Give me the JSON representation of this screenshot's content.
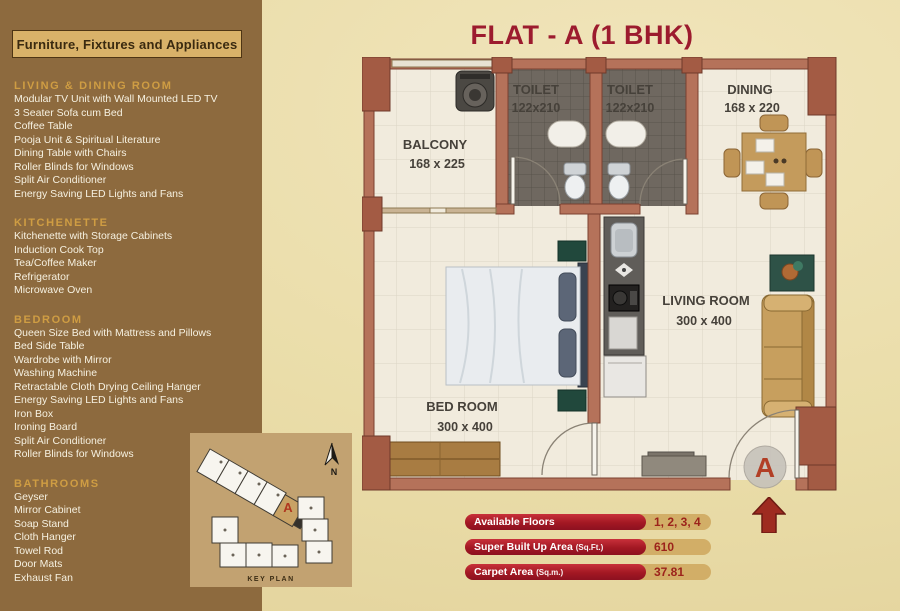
{
  "title": "FLAT - A (1 BHK)",
  "sidebar": {
    "header": "Furniture, Fixtures and Appliances",
    "sections": [
      {
        "title": "LIVING & DINING ROOM",
        "items": [
          "Modular TV Unit with Wall Mounted LED TV",
          "3 Seater Sofa cum Bed",
          "Coffee Table",
          "Pooja Unit & Spiritual Literature",
          "Dining Table with Chairs",
          "Roller Blinds for Windows",
          "Split Air Conditioner",
          "Energy Saving LED Lights and Fans"
        ]
      },
      {
        "title": "KITCHENETTE",
        "items": [
          "Kitchenette with Storage Cabinets",
          "Induction Cook Top",
          "Tea/Coffee Maker",
          "Refrigerator",
          "Microwave Oven"
        ]
      },
      {
        "title": "BEDROOM",
        "items": [
          "Queen Size Bed with Mattress and Pillows",
          "Bed Side Table",
          "Wardrobe with Mirror",
          "Washing Machine",
          "Retractable Cloth Drying Ceiling Hanger",
          "Energy Saving LED Lights and Fans",
          "Iron Box",
          "Ironing Board",
          "Split Air Conditioner",
          "Roller Blinds for Windows"
        ]
      },
      {
        "title": "BATHROOMS",
        "items": [
          "Geyser",
          "Mirror Cabinet",
          "Soap Stand",
          "Cloth Hanger",
          "Towel Rod",
          "Door Mats",
          "Exhaust Fan"
        ]
      }
    ]
  },
  "key_plan": {
    "label": "KEY PLAN",
    "north": "N",
    "unit": "A"
  },
  "floor_plan": {
    "unit_marker": "A",
    "rooms": [
      {
        "name": "BALCONY",
        "dims": "168 x 225"
      },
      {
        "name": "TOILET",
        "dims": "122x210"
      },
      {
        "name": "TOILET",
        "dims": "122x210"
      },
      {
        "name": "DINING",
        "dims": "168 x 220"
      },
      {
        "name": "BED ROOM",
        "dims": "300 x 400"
      },
      {
        "name": "LIVING ROOM",
        "dims": "300 x 400"
      }
    ]
  },
  "info_bars": [
    {
      "label": "Available Floors",
      "suffix": "",
      "value": "1, 2, 3, 4"
    },
    {
      "label": "Super Built Up Area",
      "suffix": "(Sq.Ft.)",
      "value": "610"
    },
    {
      "label": "Carpet Area",
      "suffix": "(Sq.m.)",
      "value": "37.81"
    }
  ],
  "colors": {
    "title_red": "#9c1b2e",
    "sidebar_brown": "#8d6a3e",
    "section_gold": "#cf9d43",
    "wall_salmon": "#b5725a",
    "pillar_salmon": "#a35b44",
    "floor_cream": "#f1ebdd",
    "toilet_gray": "#6f6860",
    "bar_red": "#a31823",
    "bar_tan": "#d2ae67",
    "keyplan_tan": "#c2a271"
  }
}
